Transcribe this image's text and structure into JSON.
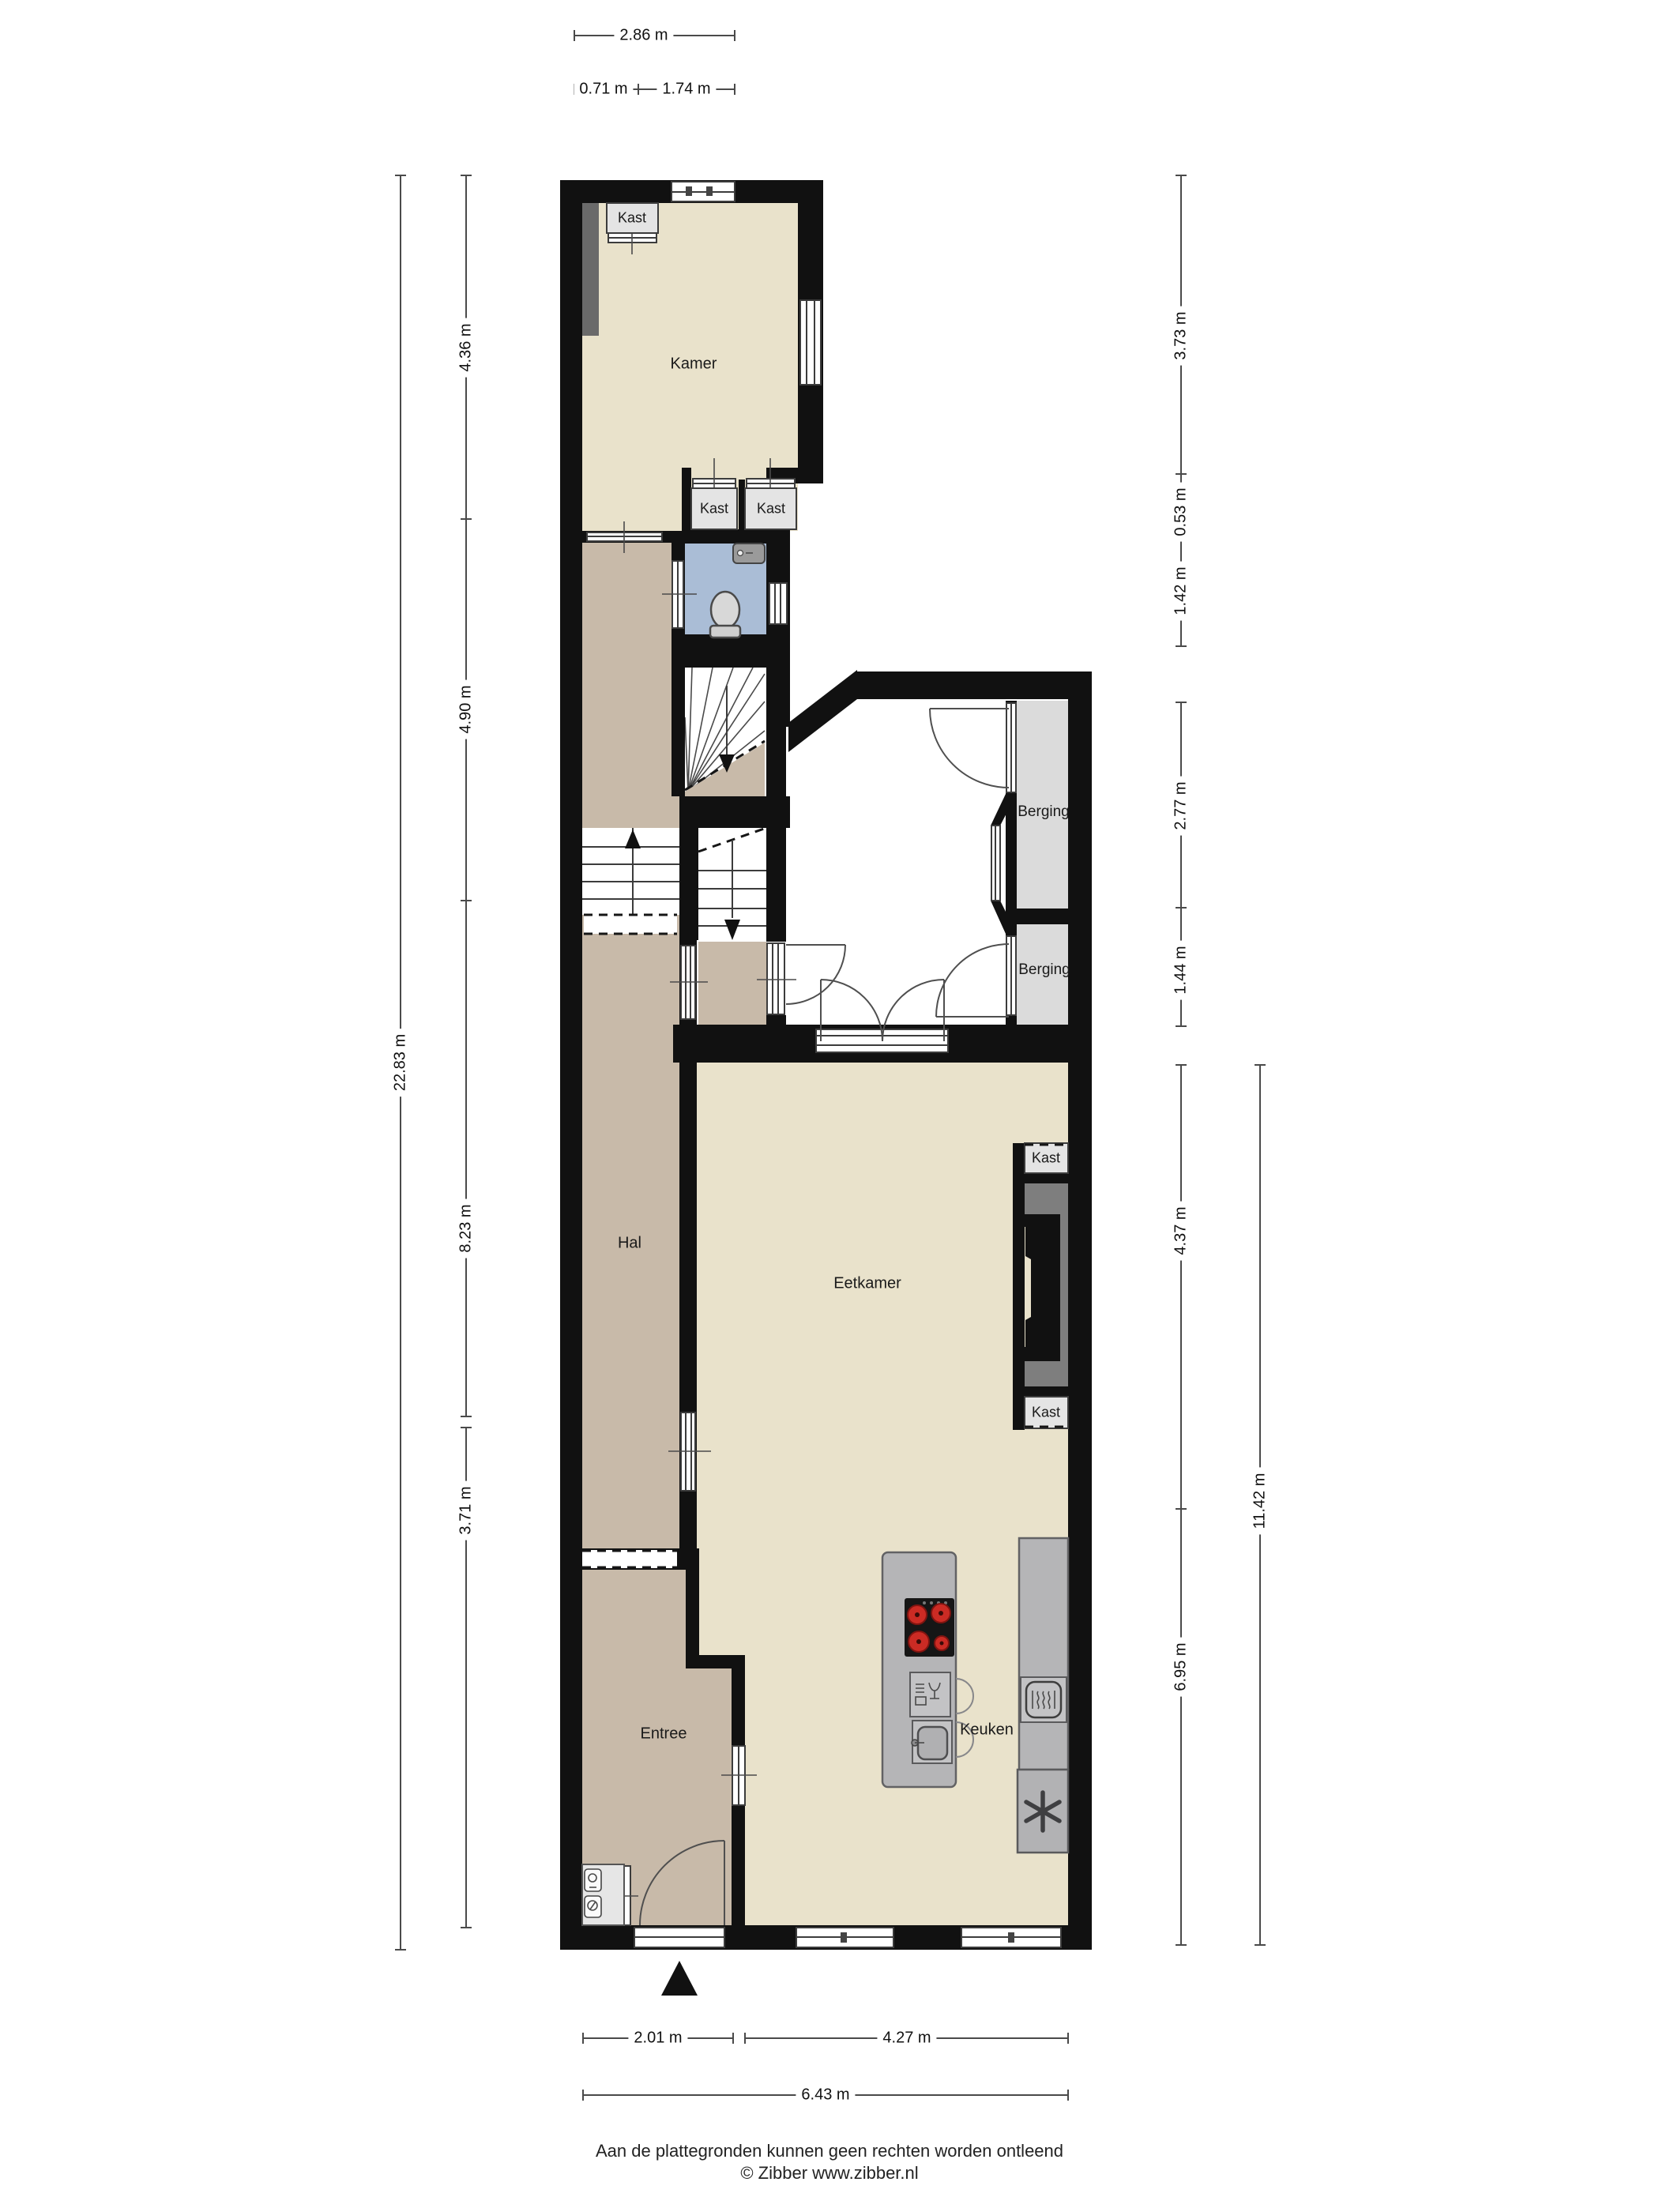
{
  "labels": {
    "kamer": "Kamer",
    "hal": "Hal",
    "eetkamer": "Eetkamer",
    "entree": "Entree",
    "keuken": "Keuken",
    "berging_upper": "Berging",
    "berging_lower": "Berging",
    "kast_kamer": "Kast",
    "kast_row_left": "Kast",
    "kast_row_right": "Kast",
    "kast_chimney_upper": "Kast",
    "kast_chimney_lower": "Kast"
  },
  "dims": {
    "top_total": "2.86 m",
    "top_seg1": "0.71 m",
    "top_seg2": "1.74 m",
    "left_total": "22.83 m",
    "left_seg1": "4.36 m",
    "left_seg2": "4.90 m",
    "left_seg3": "8.23 m",
    "left_seg4": "3.71 m",
    "right_seg1": "3.73 m",
    "right_seg2": "0.53 m",
    "right_seg3": "1.42 m",
    "right_seg4": "2.77 m",
    "right_seg5": "1.44 m",
    "right_seg6": "4.37 m",
    "right_seg7": "6.95 m",
    "right_total": "11.42 m",
    "bottom_seg1": "2.01 m",
    "bottom_seg2": "4.27 m",
    "bottom_total": "6.43 m"
  },
  "footer": {
    "disclaimer": "Aan de plattegronden kunnen geen rechten worden ontleend",
    "credit": "© Zibber www.zibber.nl"
  },
  "colors": {
    "wall": "#111111",
    "room": "#e9e2cb",
    "hall": "#c8baa9",
    "toilet": "#aabdd6",
    "storage": "#dbdbdb",
    "cabinet": "#e4e4e4",
    "counter": "#b5b5b7",
    "recess": "#7e7e7e",
    "strip": "#6a6a6a",
    "burner": "#cb2b24",
    "dim": "#4a4a4a",
    "text": "#1a1a1a"
  }
}
